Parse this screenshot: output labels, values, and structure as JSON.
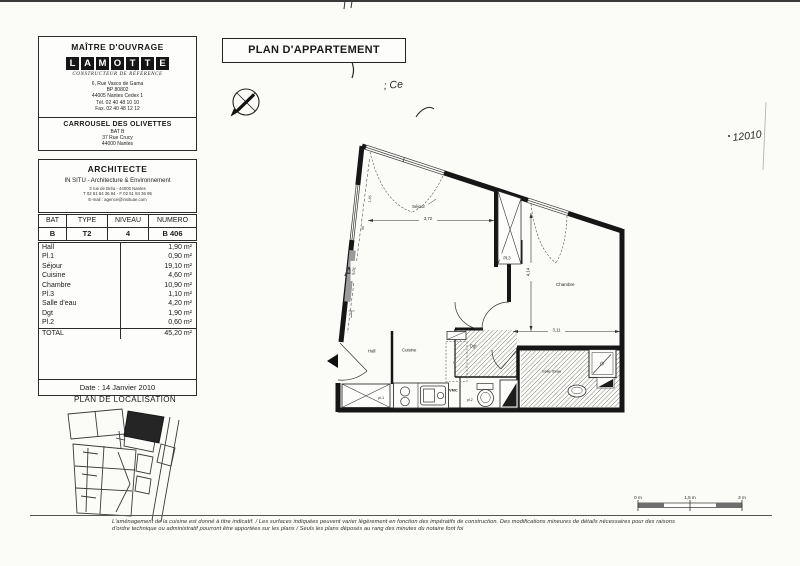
{
  "sidebar": {
    "owner_box": {
      "title": "MAÎTRE D'OUVRAGE",
      "logo_letters": "LAMOTTE",
      "logo_tagline": "CONSTRUCTEUR DE RÉFÉRENCE",
      "address_lines": [
        "6, Rue Vasco de Gama",
        "BP 80802",
        "44005 Nantes Cedex 1",
        "Tél. 02 40 48 10 10",
        "Fax. 02 40 48 12 12"
      ],
      "project_name": "CARROUSEL DES OLIVETTES",
      "project_lines": [
        "BAT B",
        "37 Rue Crucy",
        "44000 Nantes"
      ]
    },
    "architect_box": {
      "title": "ARCHITECTE",
      "firm": "IN SITU - Architecture & Environnement",
      "contact_lines": [
        "3 rue de Bréa - 44000 Nantes",
        "T 02 51 84 36 94 - F 02 51 84 36 95",
        "E-mail : agence@insituae.com"
      ]
    },
    "unit_table": {
      "headers": [
        "BAT",
        "TYPE",
        "NIVEAU",
        "NUMERO"
      ],
      "row": [
        "B",
        "T2",
        "4",
        "B 406"
      ]
    },
    "rooms_table": {
      "rows": [
        [
          "Hall",
          "1,90 m²"
        ],
        [
          "Pl.1",
          "0,90 m²"
        ],
        [
          "Séjour",
          "19,10 m²"
        ],
        [
          "Cuisine",
          "4,60 m²"
        ],
        [
          "Chambre",
          "10,90 m²"
        ],
        [
          "Pl.3",
          "1,10 m²"
        ],
        [
          "Salle d'eau",
          "4,20 m²"
        ],
        [
          "Dgt",
          "1,90 m²"
        ],
        [
          "Pl.2",
          "0,60 m²"
        ]
      ],
      "total_label": "TOTAL",
      "total_area": "45,20 m²"
    },
    "date_label": "Date : 14 Janvier 2010",
    "localisation_title": "PLAN DE LOCALISATION"
  },
  "main": {
    "title": "PLAN D'APPARTEMENT",
    "handwritten": {
      "top_left_mark": "; Ce",
      "right_mark": "12010"
    },
    "plan": {
      "rooms": {
        "sejour": "Séjour",
        "chambre": "Chambre",
        "hall": "Hall",
        "cuisine": "Cuisine",
        "dgt": "Dgt",
        "salle_eau": "Salle d'eau"
      },
      "closets": {
        "pl1": "pl.1",
        "pl2": "pl.2",
        "pl3": "Pl.3"
      },
      "equipment": {
        "vmc": "VMC",
        "fridge": "R"
      },
      "dims": {
        "sejour_width": "3,72",
        "chambre_height": "4,14",
        "chambre_width": "3,11",
        "facade": "5,01",
        "window1": "1,85",
        "window2": "90"
      },
      "watermark": {
        "a": "A",
        "t": "T"
      }
    },
    "scale_bar": {
      "labels": [
        "0 m",
        "1,5 m",
        "3 m"
      ]
    }
  },
  "footer": {
    "line1": "L'aménagement de la cuisine est donné à titre indicatif. / Les surfaces indiquées peuvent varier légèrement en fonction des impératifs de construction. Des modifications mineures de détails nécessaires pour des raisons",
    "line2": "d'ordre technique ou administratif pourront être apportées sur les plans / Seuls les plans déposés au rang des minutes du notaire font foi"
  }
}
